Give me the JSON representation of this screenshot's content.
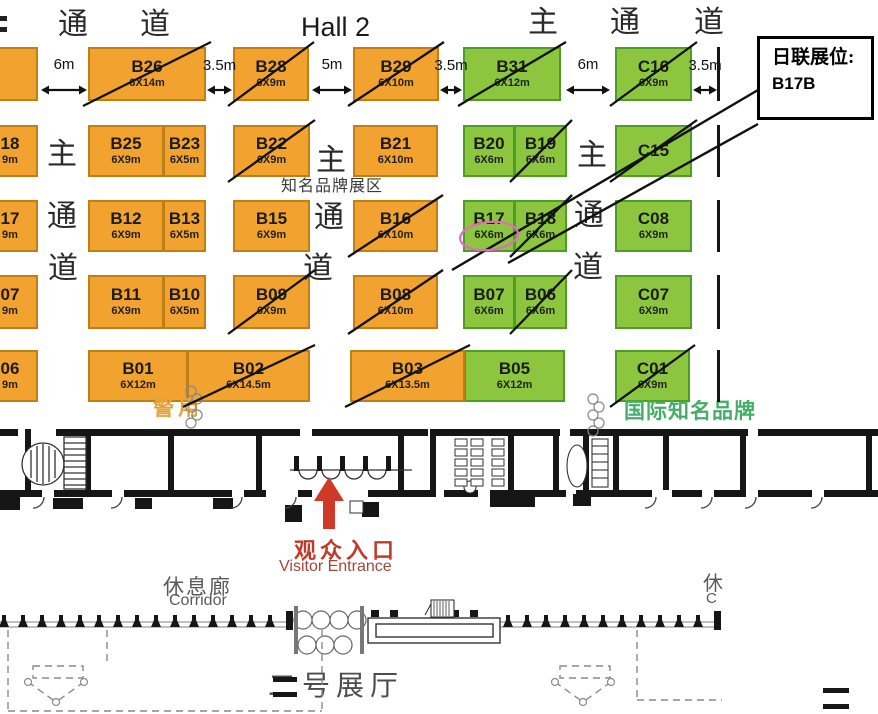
{
  "hall_label": {
    "text": "Hall 2"
  },
  "header_labels": [
    {
      "text": "通",
      "x": 58,
      "y": 10
    },
    {
      "text": "道",
      "x": 140,
      "y": 10
    },
    {
      "text": "主",
      "x": 528,
      "y": 8
    },
    {
      "text": "通",
      "x": 610,
      "y": 8
    },
    {
      "text": "道",
      "x": 694,
      "y": 8
    }
  ],
  "aisle_labels": [
    {
      "text": "主",
      "x": 47,
      "y": 140
    },
    {
      "text": "通",
      "x": 47,
      "y": 202
    },
    {
      "text": "道",
      "x": 48,
      "y": 254
    },
    {
      "text": "主",
      "x": 316,
      "y": 146
    },
    {
      "text": "通",
      "x": 314,
      "y": 203
    },
    {
      "text": "道",
      "x": 303,
      "y": 254
    },
    {
      "text": "主",
      "x": 577,
      "y": 141
    },
    {
      "text": "通",
      "x": 574,
      "y": 201
    },
    {
      "text": "道",
      "x": 573,
      "y": 253
    }
  ],
  "zone_labels": [
    {
      "text": "知名品牌展区",
      "x": 281,
      "y": 178,
      "color": "#3a3a3a",
      "size": 16,
      "bold": false,
      "ls": 1,
      "clip": 0
    },
    {
      "text": "警用",
      "x": 153,
      "y": 397,
      "color": "#E5A33C",
      "size": 21,
      "bold": true,
      "ls": 4,
      "clip": 0
    },
    {
      "text": "国际知名品牌",
      "x": 624,
      "y": 400,
      "color": "#44AE68",
      "size": 21,
      "bold": true,
      "ls": 1,
      "clip": 134
    }
  ],
  "distance_arrows": [
    {
      "label": "6m",
      "x": 41,
      "w": 46,
      "y": 90,
      "label_y": 57
    },
    {
      "label": "3.5m",
      "x": 207,
      "w": 25,
      "y": 90,
      "label_y": 58
    },
    {
      "label": "5m",
      "x": 312,
      "w": 40,
      "y": 90,
      "label_y": 57
    },
    {
      "label": "3.5m",
      "x": 440,
      "w": 22,
      "y": 90,
      "label_y": 58
    },
    {
      "label": "6m",
      "x": 566,
      "w": 44,
      "y": 90,
      "label_y": 57
    },
    {
      "label": "3.5m",
      "x": 693,
      "w": 24,
      "y": 90,
      "label_y": 58
    }
  ],
  "booths": [
    {
      "id": "B26",
      "size": "6X14m",
      "x": 88,
      "y": 47,
      "w": 118,
      "h": 54,
      "color": "orange",
      "crossed": true,
      "pairRight": false
    },
    {
      "id": "B28",
      "size": "6X9m",
      "x": 233,
      "y": 47,
      "w": 76,
      "h": 54,
      "color": "orange",
      "crossed": true,
      "pairRight": false
    },
    {
      "id": "B29",
      "size": "6X10m",
      "x": 353,
      "y": 47,
      "w": 86,
      "h": 54,
      "color": "orange",
      "crossed": true,
      "pairRight": false
    },
    {
      "id": "B31",
      "size": "6X12m",
      "x": 463,
      "y": 47,
      "w": 98,
      "h": 54,
      "color": "green",
      "crossed": true,
      "pairRight": false
    },
    {
      "id": "C16",
      "size": "6X9m",
      "x": 615,
      "y": 47,
      "w": 77,
      "h": 54,
      "color": "green",
      "crossed": true,
      "pairRight": false
    },
    {
      "id": "B25",
      "size": "6X9m",
      "x": 88,
      "y": 125,
      "w": 76,
      "h": 52,
      "color": "orange",
      "crossed": false,
      "pairRight": false
    },
    {
      "id": "B23",
      "size": "6X5m",
      "x": 164,
      "y": 125,
      "w": 42,
      "h": 52,
      "color": "orange",
      "crossed": false,
      "pairRight": true
    },
    {
      "id": "B22",
      "size": "6X9m",
      "x": 233,
      "y": 125,
      "w": 77,
      "h": 52,
      "color": "orange",
      "crossed": true,
      "pairRight": false
    },
    {
      "id": "B21",
      "size": "6X10m",
      "x": 353,
      "y": 125,
      "w": 85,
      "h": 52,
      "color": "orange",
      "crossed": false,
      "pairRight": false
    },
    {
      "id": "B20",
      "size": "6X6m",
      "x": 463,
      "y": 125,
      "w": 52,
      "h": 52,
      "color": "green",
      "crossed": false,
      "pairRight": false
    },
    {
      "id": "B19",
      "size": "6X6m",
      "x": 515,
      "y": 125,
      "w": 52,
      "h": 52,
      "color": "green",
      "crossed": true,
      "pairRight": true
    },
    {
      "id": "C15",
      "size": "",
      "x": 615,
      "y": 125,
      "w": 77,
      "h": 52,
      "color": "green",
      "crossed": true,
      "pairRight": false
    },
    {
      "id": "B12",
      "size": "6X9m",
      "x": 88,
      "y": 200,
      "w": 76,
      "h": 52,
      "color": "orange",
      "crossed": false,
      "pairRight": false
    },
    {
      "id": "B13",
      "size": "6X5m",
      "x": 164,
      "y": 200,
      "w": 42,
      "h": 52,
      "color": "orange",
      "crossed": false,
      "pairRight": true
    },
    {
      "id": "B15",
      "size": "6X9m",
      "x": 233,
      "y": 200,
      "w": 77,
      "h": 52,
      "color": "orange",
      "crossed": false,
      "pairRight": false
    },
    {
      "id": "B16",
      "size": "6X10m",
      "x": 353,
      "y": 200,
      "w": 85,
      "h": 52,
      "color": "orange",
      "crossed": true,
      "pairRight": false
    },
    {
      "id": "B17",
      "size": "6X6m",
      "x": 463,
      "y": 200,
      "w": 52,
      "h": 52,
      "color": "green",
      "crossed": false,
      "pairRight": false
    },
    {
      "id": "B18",
      "size": "6X6m",
      "x": 515,
      "y": 200,
      "w": 52,
      "h": 52,
      "color": "green",
      "crossed": true,
      "pairRight": true
    },
    {
      "id": "C08",
      "size": "6X9m",
      "x": 615,
      "y": 200,
      "w": 77,
      "h": 52,
      "color": "green",
      "crossed": false,
      "pairRight": false
    },
    {
      "id": "B11",
      "size": "6X9m",
      "x": 88,
      "y": 275,
      "w": 76,
      "h": 54,
      "color": "orange",
      "crossed": false,
      "pairRight": false
    },
    {
      "id": "B10",
      "size": "6X5m",
      "x": 164,
      "y": 275,
      "w": 42,
      "h": 54,
      "color": "orange",
      "crossed": false,
      "pairRight": true
    },
    {
      "id": "B09",
      "size": "6X9m",
      "x": 233,
      "y": 275,
      "w": 77,
      "h": 54,
      "color": "orange",
      "crossed": true,
      "pairRight": false
    },
    {
      "id": "B08",
      "size": "6X10m",
      "x": 353,
      "y": 275,
      "w": 85,
      "h": 54,
      "color": "orange",
      "crossed": true,
      "pairRight": false
    },
    {
      "id": "B07",
      "size": "6X6m",
      "x": 463,
      "y": 275,
      "w": 52,
      "h": 54,
      "color": "green",
      "crossed": false,
      "pairRight": false
    },
    {
      "id": "B06",
      "size": "6X6m",
      "x": 515,
      "y": 275,
      "w": 52,
      "h": 54,
      "color": "green",
      "crossed": true,
      "pairRight": true
    },
    {
      "id": "C07",
      "size": "6X9m",
      "x": 615,
      "y": 275,
      "w": 77,
      "h": 54,
      "color": "green",
      "crossed": false,
      "pairRight": false
    },
    {
      "id": "B01",
      "size": "6X12m",
      "x": 88,
      "y": 350,
      "w": 100,
      "h": 52,
      "color": "orange",
      "crossed": false,
      "pairRight": false
    },
    {
      "id": "B02",
      "size": "6X14.5m",
      "x": 188,
      "y": 350,
      "w": 122,
      "h": 52,
      "color": "orange",
      "crossed": true,
      "pairRight": true
    },
    {
      "id": "B03",
      "size": "6X13.5m",
      "x": 350,
      "y": 350,
      "w": 115,
      "h": 52,
      "color": "orange",
      "crossed": true,
      "pairRight": false
    },
    {
      "id": "B05",
      "size": "6X12m",
      "x": 465,
      "y": 350,
      "w": 100,
      "h": 52,
      "color": "green",
      "crossed": false,
      "pairRight": true
    },
    {
      "id": "C01",
      "size": "6X9m",
      "x": 615,
      "y": 350,
      "w": 75,
      "h": 52,
      "color": "green",
      "crossed": true,
      "pairRight": false
    }
  ],
  "edge_booths": [
    {
      "lines": [
        "",
        ""
      ],
      "y": 47,
      "h": 54
    },
    {
      "lines": [
        "18",
        "9m"
      ],
      "y": 125,
      "h": 52
    },
    {
      "lines": [
        "17",
        "9m"
      ],
      "y": 200,
      "h": 52
    },
    {
      "lines": [
        "07",
        "9m"
      ],
      "y": 275,
      "h": 54
    },
    {
      "lines": [
        "06",
        "9m"
      ],
      "y": 350,
      "h": 52
    }
  ],
  "callout": {
    "line1": "日联展位:",
    "line2": "B17B"
  },
  "entrance": {
    "cn": "观众入口",
    "en": "Visitor Entrance"
  },
  "corridor_left": {
    "cn": "休息廊",
    "en": "Corridor"
  },
  "corridor_right_partial": {
    "cn": "休",
    "en": "C"
  },
  "bottom_hall": {
    "text": "二号展厅"
  },
  "highlight": {
    "booth": "B17",
    "color": "#E468C8"
  },
  "colors": {
    "orange": "#F1A22F",
    "orange_border": "#C07F14",
    "green": "#8CC63F",
    "green_border": "#4E9D26",
    "cross": "#111111",
    "red_arrow": "#CE3A27"
  }
}
